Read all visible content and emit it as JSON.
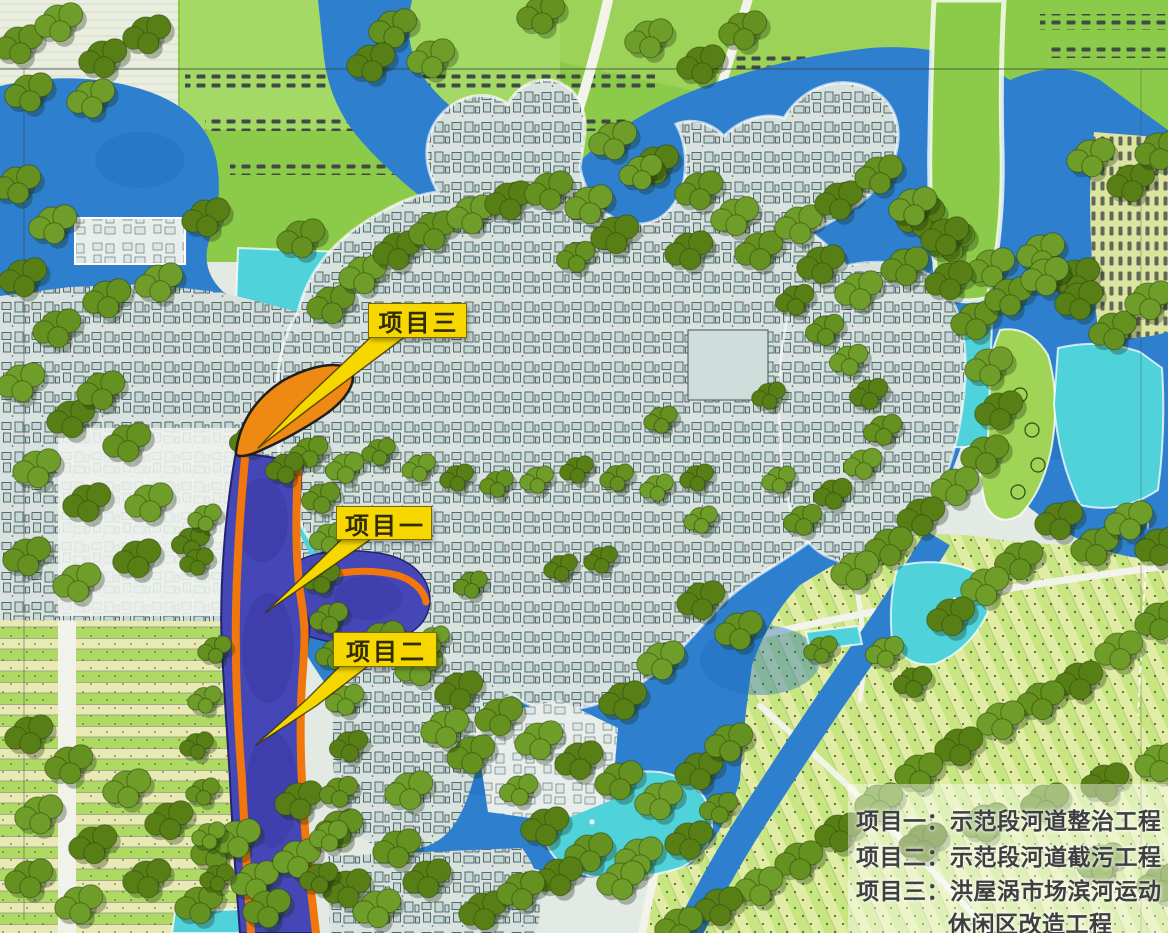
{
  "callouts": {
    "project3": "项目三",
    "project1": "项目一",
    "project2": "项目二"
  },
  "legend": {
    "lines": [
      "项目一：示范段河道整治工程",
      "项目二：示范段河道截污工程",
      "项目三：洪屋涡市场滨河运动",
      "休闲区改造工程"
    ]
  },
  "colors": {
    "water": "#2e80cf",
    "pond": "#4fd2da",
    "field": "#8ccb49",
    "field-light": "#cfe78e",
    "tree": "#649120",
    "urban": "#d8e3e0",
    "river-band": "#4547b6",
    "stripe-orange": "#f1770d",
    "project-orange": "#ee8a12",
    "callout-yellow": "#f6d800",
    "legend-text": "#3f3f3f"
  }
}
